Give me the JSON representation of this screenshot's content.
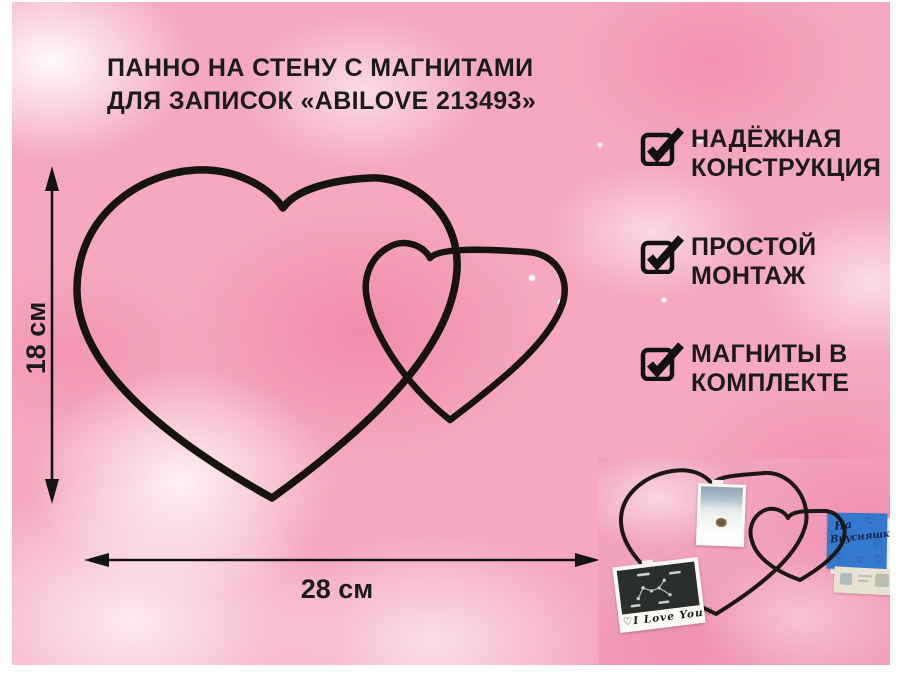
{
  "title": {
    "line1": "ПАННО НА СТЕНУ С МАГНИТАМИ",
    "line2": "ДЛЯ ЗАПИСОК «ABILOVE 213493»"
  },
  "features": [
    {
      "line1": "НАДЁЖНАЯ",
      "line2": "КОНСТРУКЦИЯ"
    },
    {
      "line1": "ПРОСТОЙ",
      "line2": "МОНТАЖ"
    },
    {
      "line1": "МАГНИТЫ В",
      "line2": "КОМПЛЕКТЕ"
    }
  ],
  "dimensions": {
    "height": "18 см",
    "width": "28 см"
  },
  "inset": {
    "note": {
      "line1": "На",
      "line2": "Вкусняшку"
    },
    "photo_caption": "I Love You",
    "heart_doodle": "♡"
  },
  "colors": {
    "background_pink": "#f5a8bf",
    "accent_hot_pink": "#ee6e98",
    "text_black": "#1b1b1b",
    "wire_black": "#17130e",
    "note_blue": "#3579cf"
  }
}
